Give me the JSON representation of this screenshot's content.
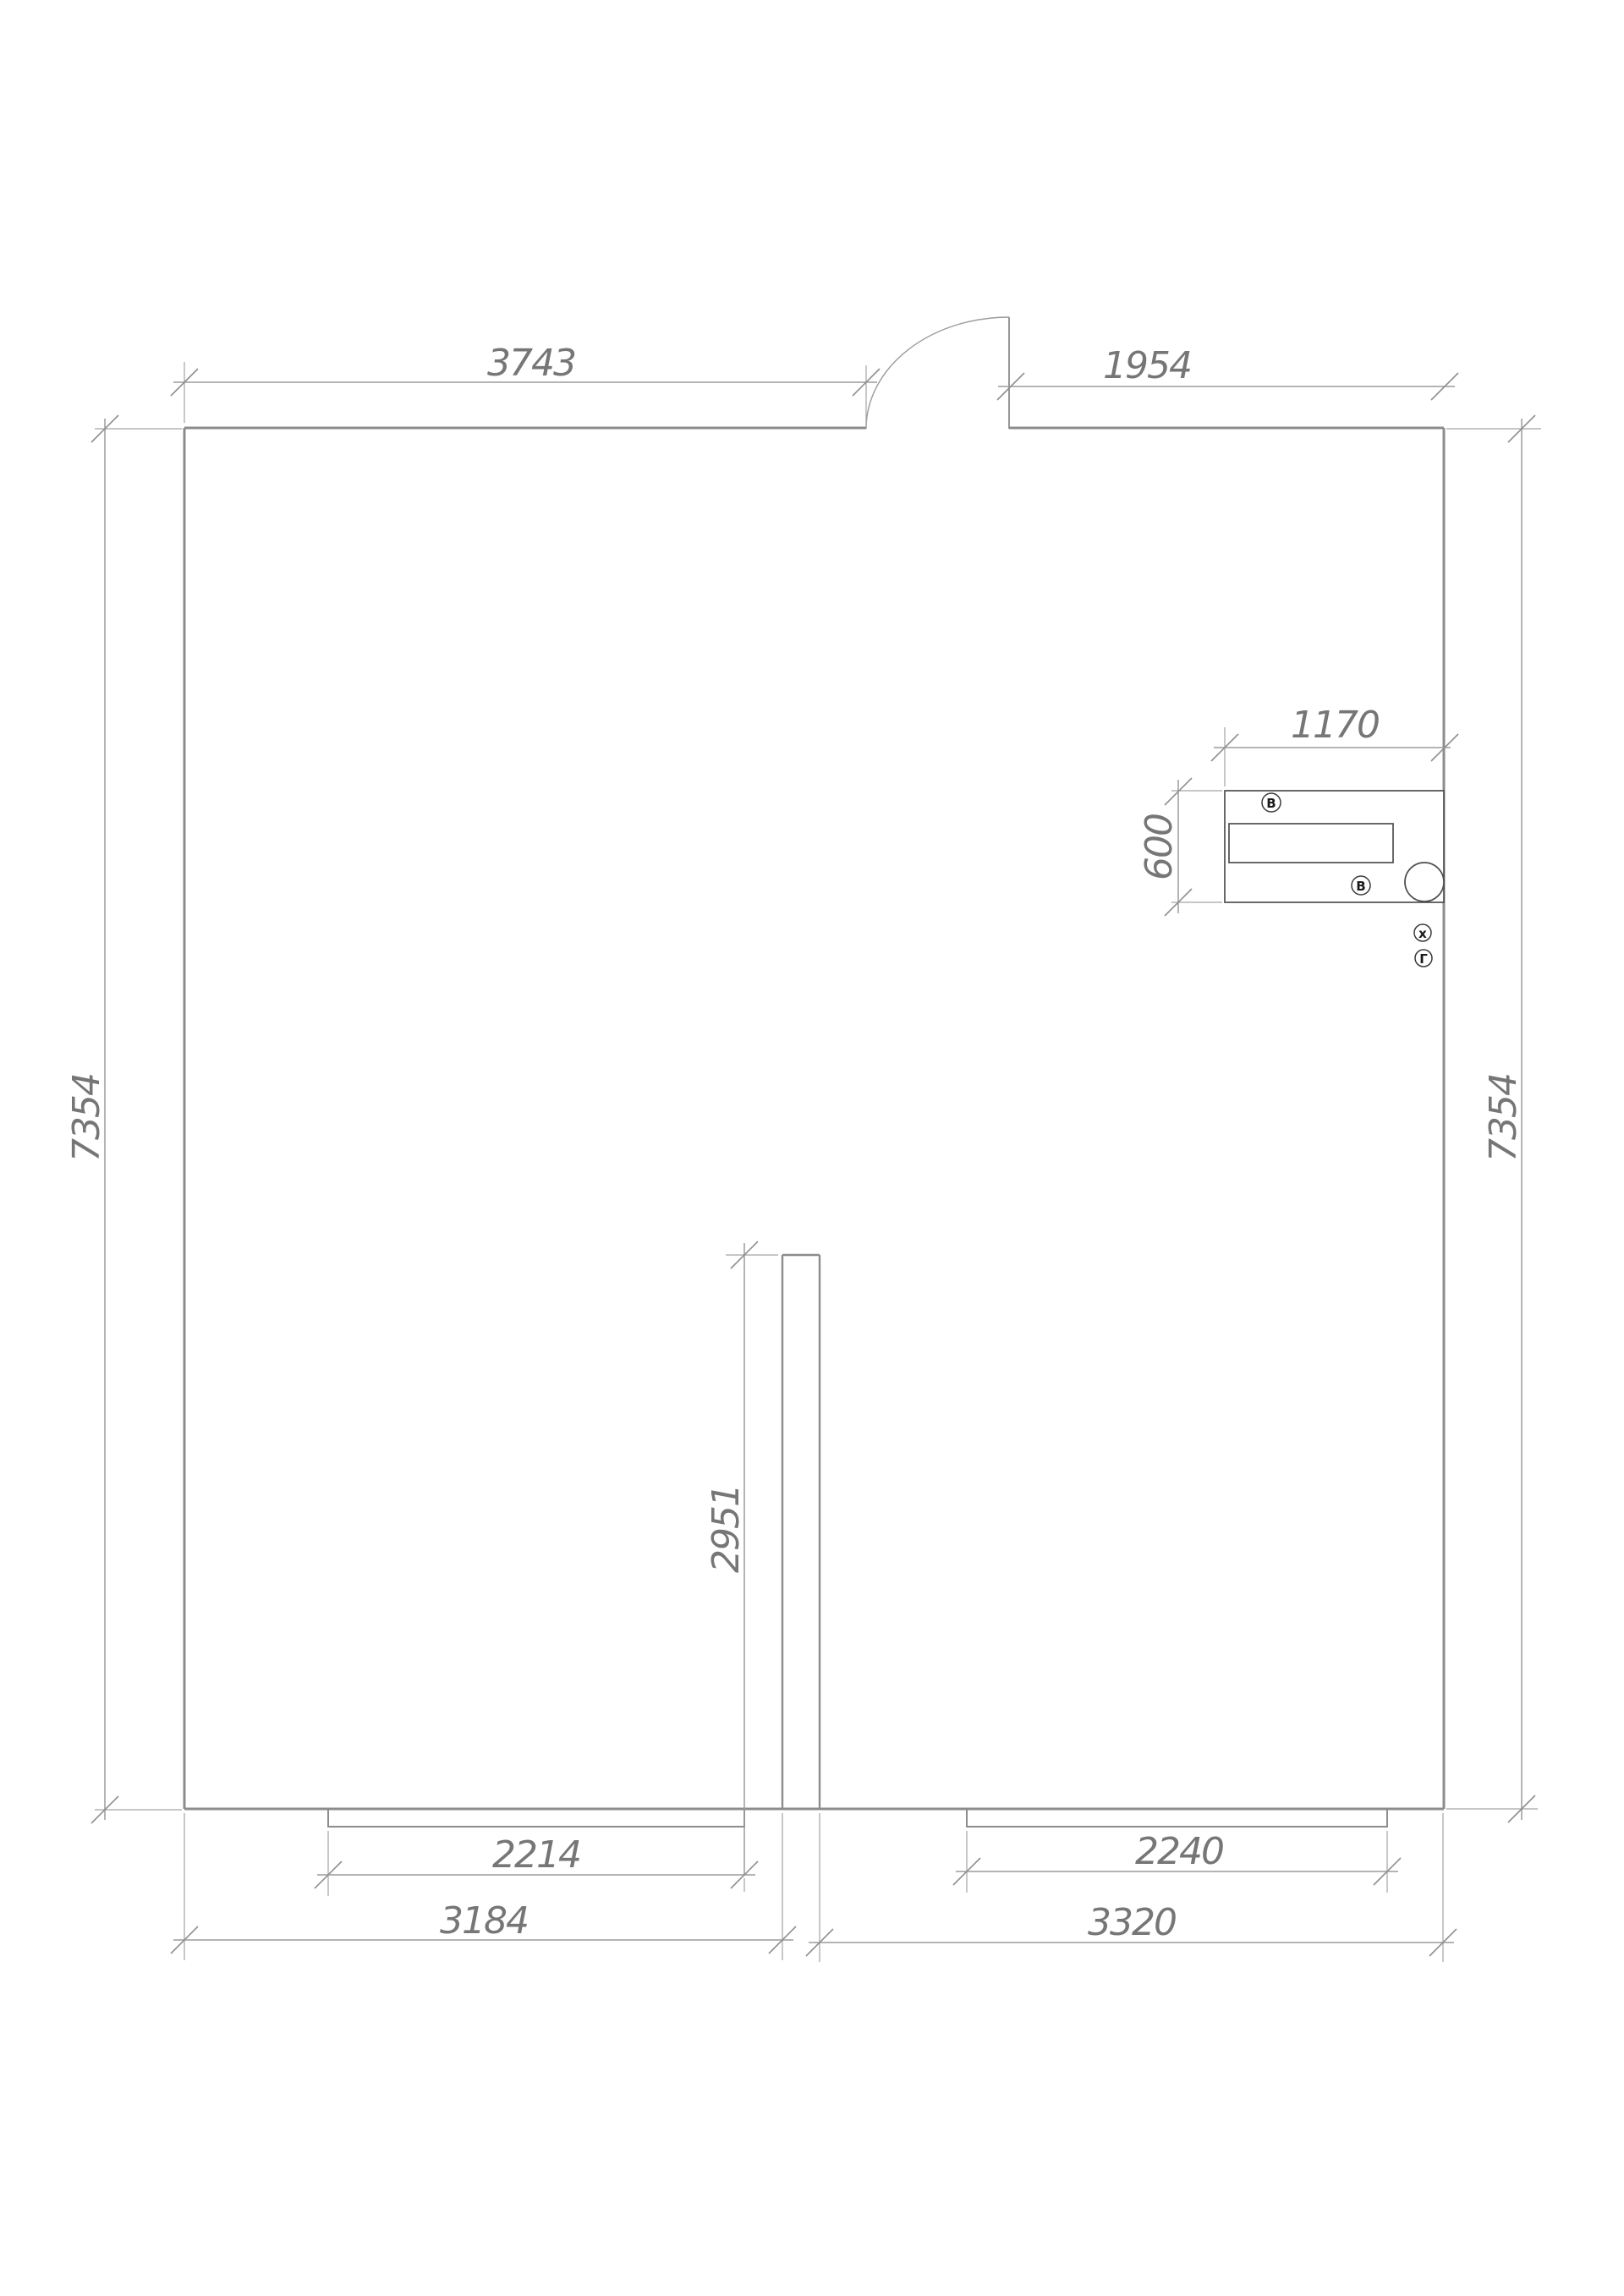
{
  "drawing": {
    "type": "apartment-floor-plan",
    "background_color": "#ffffff",
    "wall_color": "#8c8c8c",
    "dimension_line_color": "#9b9b9b",
    "dimension_text_color": "#767676",
    "fixture_color": "#4f4f4f",
    "dimension_labels": {
      "top_wall_left": "3743",
      "top_wall_right": "1954",
      "left_wall": "7354",
      "right_wall": "7354",
      "counter_width": "1170",
      "counter_depth": "600",
      "partition": "2951",
      "window_left": "2214",
      "room_left": "3184",
      "window_right": "2240",
      "room_right": "3320"
    },
    "utility_markers": [
      {
        "label": "В"
      },
      {
        "label": "В"
      },
      {
        "label": "х"
      },
      {
        "label": "Г"
      }
    ]
  }
}
